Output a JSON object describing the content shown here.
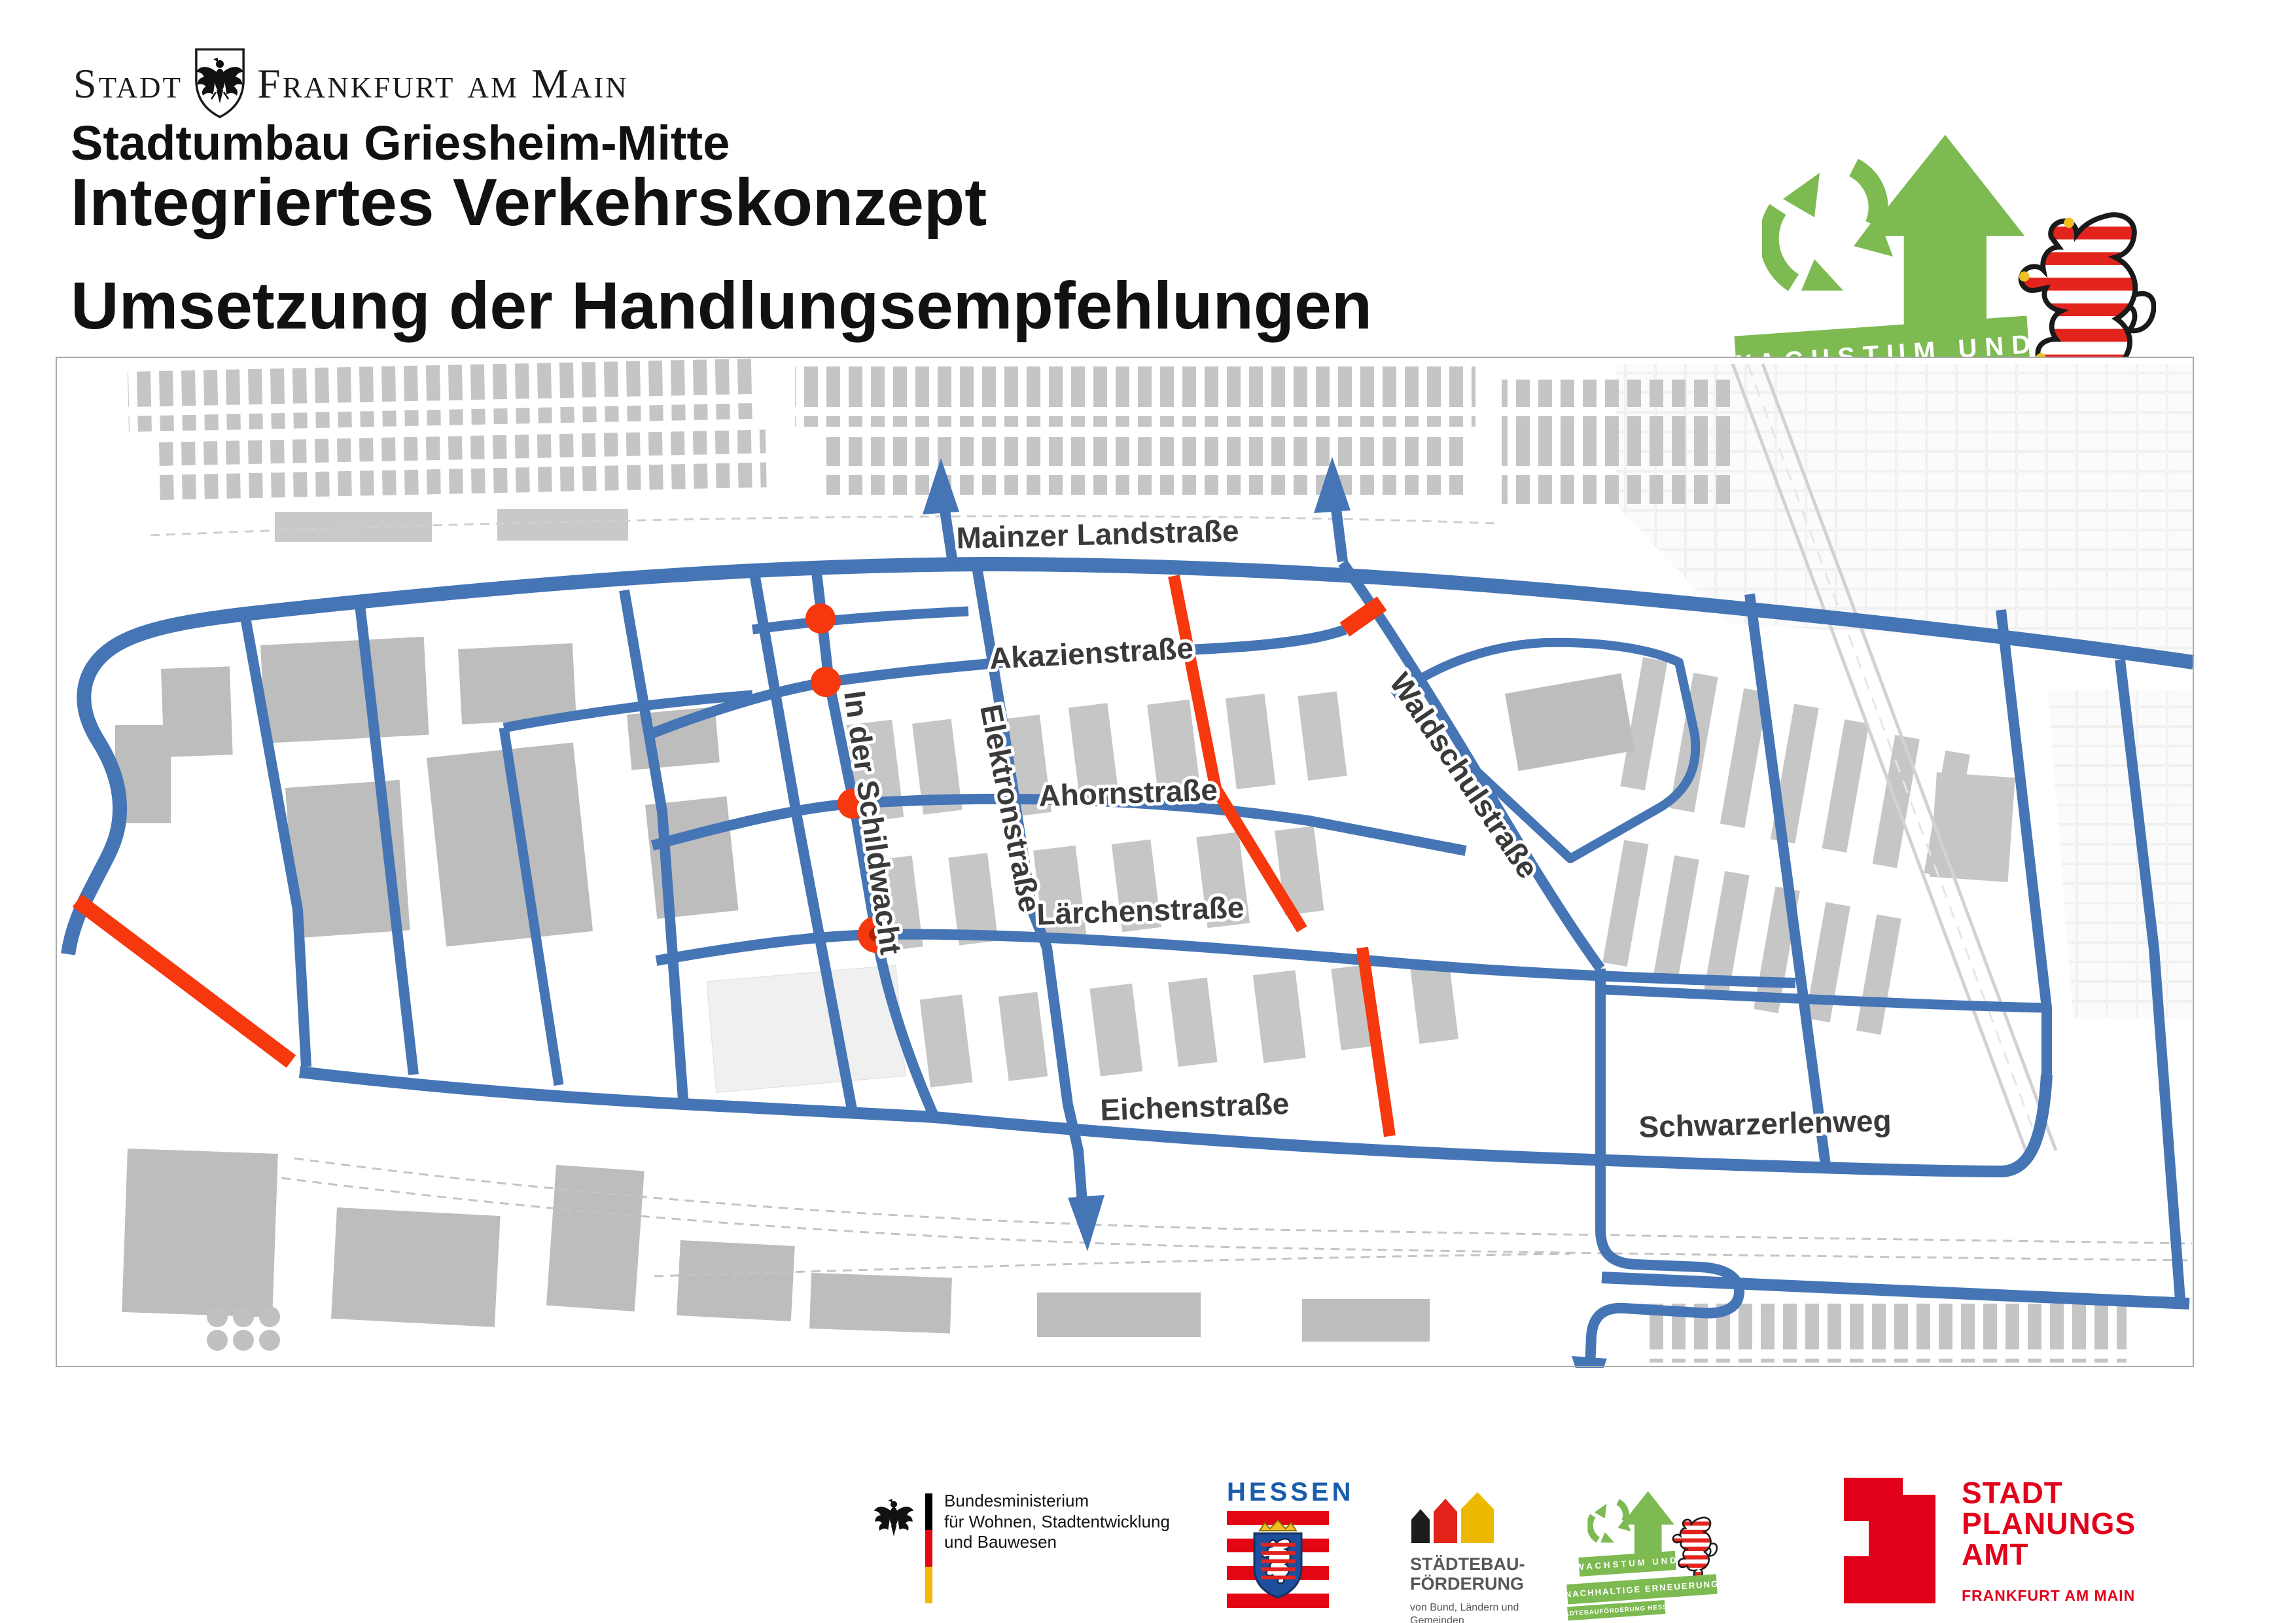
{
  "city_header": {
    "stadt": "Stadt",
    "city": "Frankfurt am Main"
  },
  "titles": {
    "project": "Stadtumbau Griesheim-Mitte",
    "main": "Integriertes Verkehrskonzept",
    "sub": "Umsetzung der Handlungsempfehlungen"
  },
  "growth_logo": {
    "banner1": "WACHSTUM UND",
    "banner2": "NACHHALTIGE ERNEUERUNG",
    "banner3": "STÄDTEBAUFÖRDERUNG HESSEN",
    "green": "#7dba52"
  },
  "map": {
    "colors": {
      "route": "#4575b5",
      "highlight": "#f5380e",
      "building": "#c6c6c6"
    },
    "streets": [
      {
        "id": "mainzer-landstrasse",
        "label": "Mainzer Landstraße"
      },
      {
        "id": "akazienstrasse",
        "label": "Akazienstraße"
      },
      {
        "id": "ahornstrasse",
        "label": "Ahornstraße"
      },
      {
        "id": "laerchenstrasse",
        "label": "Lärchenstraße"
      },
      {
        "id": "eichenstrasse",
        "label": "Eichenstraße"
      },
      {
        "id": "schwarzerlenweg",
        "label": "Schwarzerlenweg"
      },
      {
        "id": "in-der-schildwacht",
        "label": "In der Schildwacht"
      },
      {
        "id": "elektronstrasse",
        "label": "Elektronstraße"
      },
      {
        "id": "waldschulstrasse",
        "label": "Waldschulstraße"
      }
    ]
  },
  "footer": {
    "bmwsb": {
      "line1": "Bundesministerium",
      "line2": "für Wohnen, Stadtentwicklung",
      "line3": "und Bauwesen"
    },
    "hessen": {
      "name": "HESSEN"
    },
    "sbf": {
      "line1": "STÄDTEBAU-",
      "line2": "FÖRDERUNG",
      "sub1": "von Bund, Ländern und",
      "sub2": "Gemeinden"
    },
    "spa": {
      "line1": "STADT",
      "line2": "PLANUNGS",
      "line3": "AMT",
      "sub": "FRANKFURT AM MAIN"
    }
  }
}
